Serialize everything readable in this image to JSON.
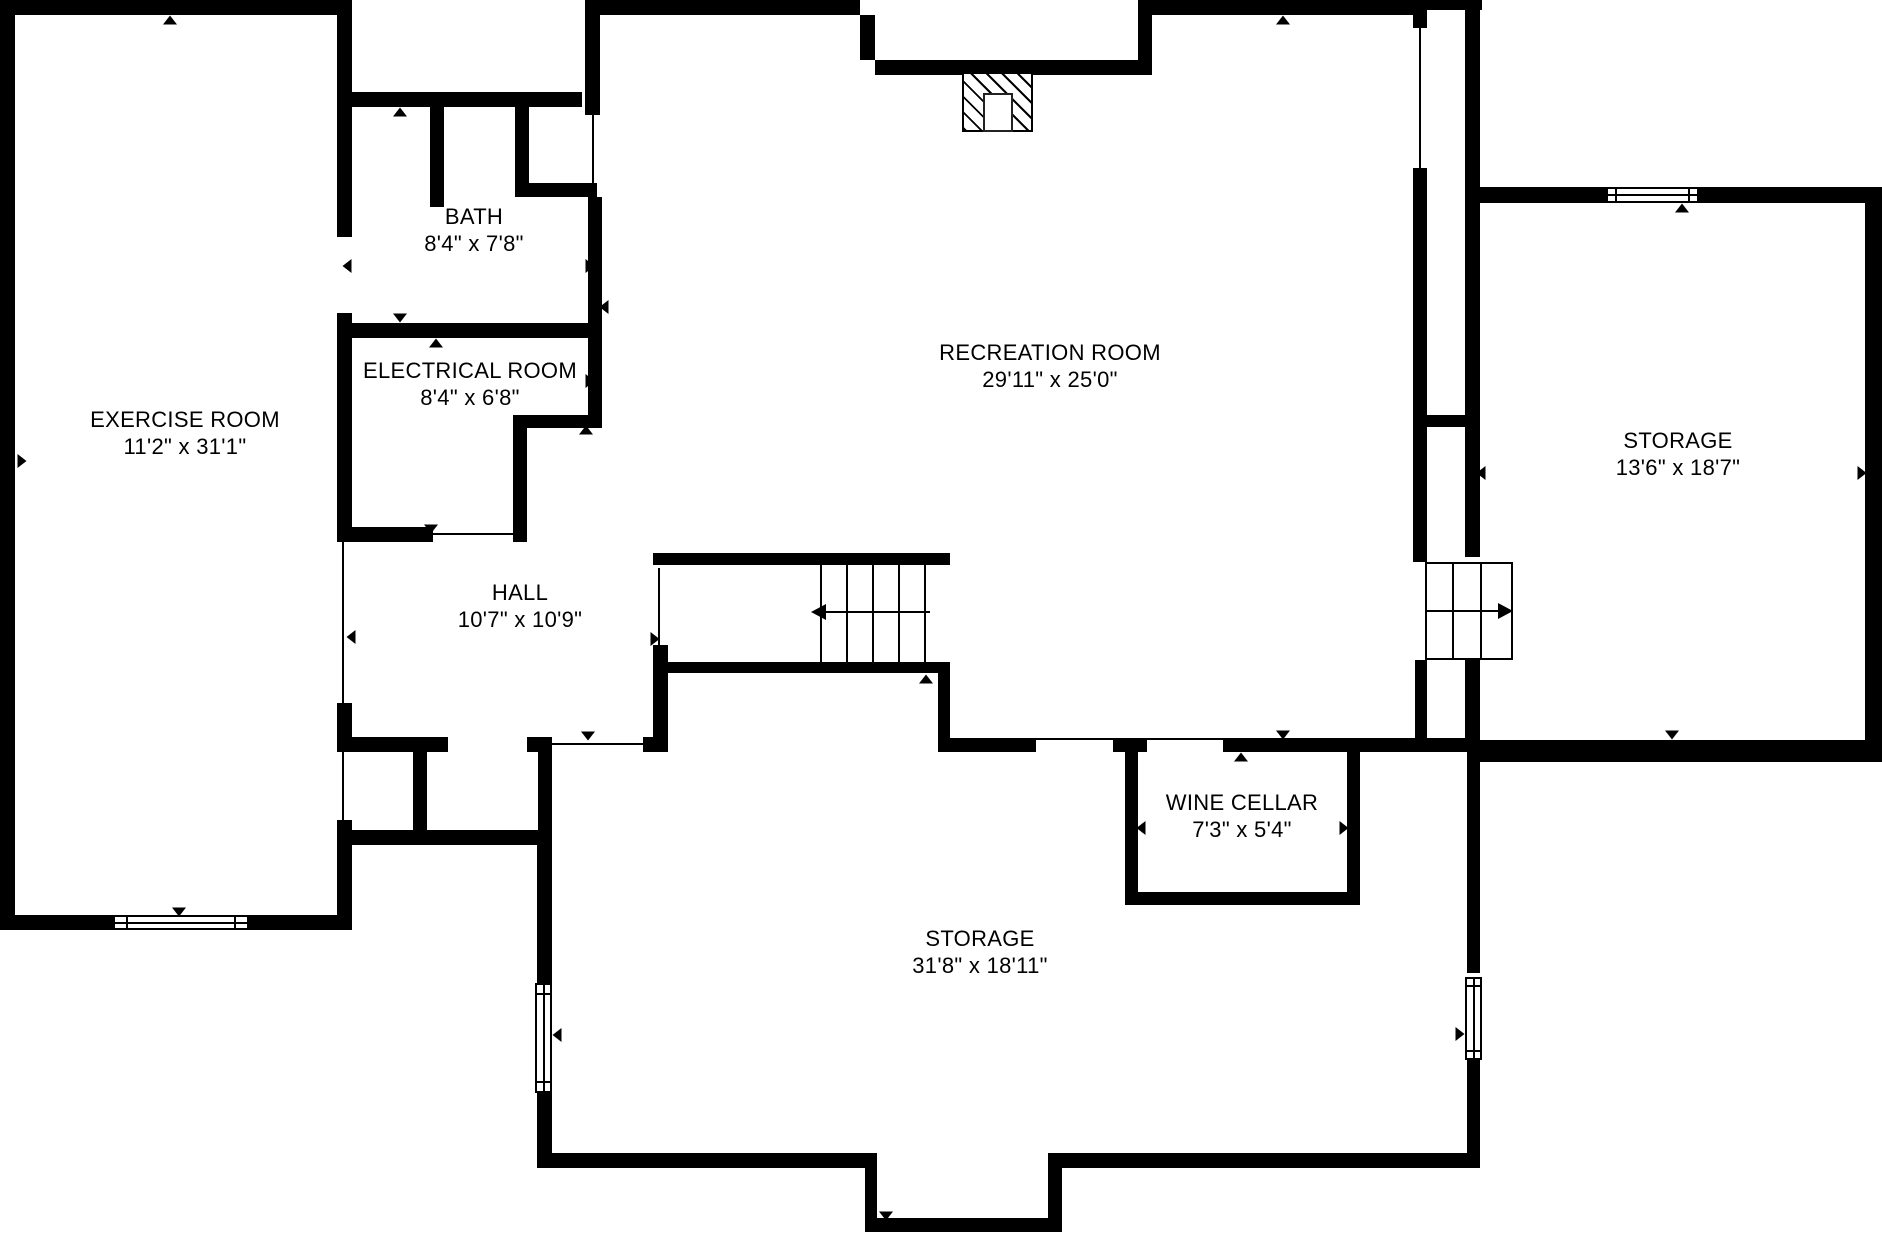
{
  "colors": {
    "wall": "#000000",
    "background": "#ffffff",
    "line": "#000000"
  },
  "rooms": [
    {
      "id": "exercise-room",
      "name": "EXERCISE ROOM",
      "dimensions": "11'2\" x 31'1\"",
      "cx": 185,
      "top": 406
    },
    {
      "id": "bath",
      "name": "BATH",
      "dimensions": "8'4\" x 7'8\"",
      "cx": 474,
      "top": 203
    },
    {
      "id": "electrical-room",
      "name": "ELECTRICAL ROOM",
      "dimensions": "8'4\" x 6'8\"",
      "cx": 470,
      "top": 357
    },
    {
      "id": "recreation-room",
      "name": "RECREATION ROOM",
      "dimensions": "29'11\" x 25'0\"",
      "cx": 1050,
      "top": 339
    },
    {
      "id": "storage-right",
      "name": "STORAGE",
      "dimensions": "13'6\" x 18'7\"",
      "cx": 1678,
      "top": 427
    },
    {
      "id": "hall",
      "name": "HALL",
      "dimensions": "10'7\" x 10'9\"",
      "cx": 520,
      "top": 579
    },
    {
      "id": "wine-cellar",
      "name": "WINE CELLAR",
      "dimensions": "7'3\" x 5'4\"",
      "cx": 1242,
      "top": 789
    },
    {
      "id": "storage-bottom",
      "name": "STORAGE",
      "dimensions": "31'8\" x 18'11\"",
      "cx": 980,
      "top": 925
    }
  ],
  "geometry": {
    "walls": [
      [
        0,
        0,
        15,
        930
      ],
      [
        0,
        0,
        352,
        15
      ],
      [
        337,
        15,
        15,
        222
      ],
      [
        337,
        313,
        15,
        217
      ],
      [
        337,
        703,
        15,
        49
      ],
      [
        337,
        820,
        15,
        110
      ],
      [
        0,
        915,
        352,
        15
      ],
      [
        352,
        92,
        230,
        15
      ],
      [
        430,
        107,
        14,
        100
      ],
      [
        515,
        107,
        14,
        90
      ],
      [
        527,
        183,
        70,
        14
      ],
      [
        585,
        0,
        15,
        115
      ],
      [
        588,
        197,
        14,
        231
      ],
      [
        337,
        323,
        265,
        15
      ],
      [
        513,
        415,
        89,
        13
      ],
      [
        513,
        428,
        14,
        114
      ],
      [
        337,
        527,
        96,
        15
      ],
      [
        585,
        0,
        275,
        15
      ],
      [
        860,
        15,
        15,
        45
      ],
      [
        875,
        60,
        277,
        15
      ],
      [
        1138,
        0,
        14,
        75
      ],
      [
        1152,
        0,
        261,
        15
      ],
      [
        653,
        553,
        297,
        12
      ],
      [
        653,
        662,
        297,
        11
      ],
      [
        653,
        645,
        15,
        102
      ],
      [
        938,
        662,
        12,
        88
      ],
      [
        337,
        737,
        111,
        15
      ],
      [
        527,
        737,
        25,
        15
      ],
      [
        413,
        752,
        14,
        78
      ],
      [
        538,
        752,
        14,
        93
      ],
      [
        337,
        830,
        215,
        15
      ],
      [
        643,
        737,
        25,
        15
      ],
      [
        938,
        738,
        98,
        14
      ],
      [
        1113,
        738,
        34,
        14
      ],
      [
        1223,
        738,
        257,
        14
      ],
      [
        1125,
        752,
        13,
        140
      ],
      [
        1347,
        752,
        13,
        140
      ],
      [
        1125,
        892,
        235,
        13
      ],
      [
        1413,
        0,
        69,
        10
      ],
      [
        1413,
        10,
        14,
        18
      ],
      [
        1413,
        168,
        14,
        259
      ],
      [
        1413,
        415,
        52,
        12
      ],
      [
        1413,
        427,
        14,
        135
      ],
      [
        1415,
        660,
        12,
        78
      ],
      [
        1465,
        10,
        15,
        177
      ],
      [
        1465,
        203,
        15,
        354
      ],
      [
        1465,
        660,
        15,
        92
      ],
      [
        1465,
        187,
        143,
        16
      ],
      [
        1699,
        187,
        183,
        16
      ],
      [
        1865,
        187,
        17,
        575
      ],
      [
        1467,
        740,
        415,
        22
      ],
      [
        1467,
        752,
        13,
        221
      ],
      [
        1467,
        1060,
        13,
        108
      ],
      [
        537,
        845,
        15,
        138
      ],
      [
        537,
        1093,
        15,
        60
      ],
      [
        537,
        1153,
        340,
        15
      ],
      [
        865,
        1153,
        12,
        79
      ],
      [
        865,
        1218,
        197,
        14
      ],
      [
        1048,
        1153,
        14,
        79
      ],
      [
        1048,
        1153,
        432,
        15
      ]
    ],
    "openings": [
      [
        342,
        530,
        2,
        173
      ],
      [
        342,
        752,
        2,
        68
      ],
      [
        433,
        533,
        80,
        2
      ],
      [
        592,
        115,
        2,
        73
      ],
      [
        1419,
        28,
        2,
        140
      ],
      [
        658,
        568,
        2,
        79
      ],
      [
        552,
        743,
        101,
        2
      ],
      [
        1036,
        738,
        77,
        2
      ],
      [
        1147,
        738,
        76,
        2
      ]
    ],
    "windows": [
      {
        "x": 113,
        "y": 915,
        "w": 136,
        "h": 15,
        "o": "h"
      },
      {
        "x": 1606,
        "y": 187,
        "w": 93,
        "h": 16,
        "o": "h"
      },
      {
        "x": 535,
        "y": 983,
        "w": 17,
        "h": 110,
        "o": "v"
      },
      {
        "x": 1465,
        "y": 977,
        "w": 17,
        "h": 83,
        "o": "v"
      }
    ],
    "markers": [
      [
        170,
        20,
        "up"
      ],
      [
        22,
        461,
        "right"
      ],
      [
        347,
        266,
        "left"
      ],
      [
        590,
        266,
        "right"
      ],
      [
        604,
        307,
        "left"
      ],
      [
        400,
        112,
        "up"
      ],
      [
        400,
        318,
        "down"
      ],
      [
        436,
        343,
        "up"
      ],
      [
        347,
        372,
        "left"
      ],
      [
        590,
        381,
        "right"
      ],
      [
        586,
        430,
        "up"
      ],
      [
        431,
        529,
        "down"
      ],
      [
        346,
        464,
        "right"
      ],
      [
        351,
        637,
        "left"
      ],
      [
        655,
        639,
        "right"
      ],
      [
        588,
        736,
        "down"
      ],
      [
        926,
        679,
        "up"
      ],
      [
        1283,
        20,
        "up"
      ],
      [
        1283,
        735,
        "down"
      ],
      [
        1241,
        757,
        "up"
      ],
      [
        1141,
        828,
        "left"
      ],
      [
        1344,
        828,
        "right"
      ],
      [
        1240,
        899,
        "down"
      ],
      [
        1481,
        473,
        "left"
      ],
      [
        1862,
        473,
        "right"
      ],
      [
        1682,
        208,
        "up"
      ],
      [
        1672,
        735,
        "down"
      ],
      [
        557,
        1035,
        "left"
      ],
      [
        1460,
        1034,
        "right"
      ],
      [
        886,
        1216,
        "down"
      ],
      [
        179,
        912,
        "down"
      ]
    ],
    "fireplace": {
      "x": 962,
      "y": 72,
      "w": 71,
      "h": 60,
      "inner": {
        "x": 983,
        "y": 93,
        "w": 30,
        "h": 39
      }
    },
    "stairs_main": {
      "y1": 565,
      "y2": 662,
      "treads_x": [
        820,
        846,
        872,
        898,
        924
      ],
      "arrow": {
        "x1": 826,
        "x2": 930,
        "y": 611,
        "dir": "left"
      }
    },
    "stairs_side": {
      "x": 1425,
      "y": 562,
      "w": 88,
      "h": 98,
      "treads_x": [
        1452,
        1480
      ],
      "mid_y": 610,
      "arrow": {
        "x1": 1432,
        "x2": 1498,
        "y": 610,
        "dir": "right"
      }
    }
  }
}
